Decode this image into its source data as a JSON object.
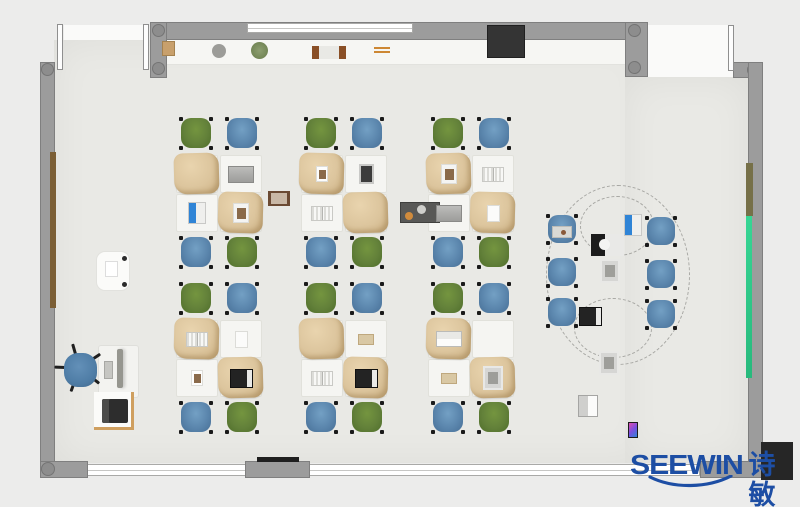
{
  "meta": {
    "description": "Top-down 3D rendered floor plan of a classroom / office furniture layout"
  },
  "logo": {
    "brand": "SEEWIN",
    "brand_cn": "诗敏",
    "color": "#1d4ea4"
  },
  "colors": {
    "outside": "#ececeb",
    "floor": "#e9e9e5",
    "wall": "#9c9c9c",
    "window": "#ffffff",
    "chair_green": "#63813a",
    "chair_blue": "#5b86ad",
    "desk_white": "#f5f5f2",
    "desk_cover_tan": "#dcc59d",
    "board_green": "#2fcd8c",
    "board_brown": "#7b5e35",
    "board_olive": "#767048",
    "cabinet_black": "#343434"
  },
  "shelf_items": [
    {
      "type": "basket",
      "x": 162,
      "y": 41
    },
    {
      "type": "wreath",
      "x": 180,
      "y": 40
    },
    {
      "type": "plate",
      "x": 212,
      "y": 44
    },
    {
      "type": "plant",
      "x": 251,
      "y": 42
    },
    {
      "type": "frame",
      "x": 268,
      "y": 44
    },
    {
      "type": "books",
      "x": 312,
      "y": 46
    },
    {
      "type": "sticks",
      "x": 374,
      "y": 47
    },
    {
      "type": "machine",
      "x": 400,
      "y": 40
    },
    {
      "type": "box",
      "x": 552,
      "y": 43
    },
    {
      "type": "device-bw",
      "x": 591,
      "y": 39
    }
  ],
  "furniture": {
    "cluster_chair_colors": [
      "green",
      "blue",
      "blue",
      "green"
    ],
    "clusters": [
      {
        "x": 176,
        "y": 116,
        "desks": [
          {
            "cover": true,
            "item": ""
          },
          {
            "cover": false,
            "item": "laptop-gray"
          },
          {
            "cover": false,
            "item": "laptop-blue"
          },
          {
            "cover": true,
            "item": "book-photo"
          }
        ]
      },
      {
        "x": 301,
        "y": 116,
        "desks": [
          {
            "cover": true,
            "item": "photo"
          },
          {
            "cover": false,
            "item": "tablet-gray"
          },
          {
            "cover": false,
            "item": "book-open"
          },
          {
            "cover": true,
            "item": ""
          }
        ]
      },
      {
        "x": 428,
        "y": 116,
        "desks": [
          {
            "cover": true,
            "item": "book-photo"
          },
          {
            "cover": false,
            "item": "book-open"
          },
          {
            "cover": false,
            "item": "laptop-gray"
          },
          {
            "cover": true,
            "item": "paper"
          }
        ]
      },
      {
        "x": 176,
        "y": 281,
        "desks": [
          {
            "cover": true,
            "item": "book-open"
          },
          {
            "cover": false,
            "item": "paper"
          },
          {
            "cover": false,
            "item": "photo"
          },
          {
            "cover": true,
            "item": "laptop-dark"
          }
        ]
      },
      {
        "x": 301,
        "y": 281,
        "desks": [
          {
            "cover": true,
            "item": ""
          },
          {
            "cover": false,
            "item": "book-tan"
          },
          {
            "cover": false,
            "item": "book-open"
          },
          {
            "cover": true,
            "item": "laptop-dark"
          }
        ]
      },
      {
        "x": 428,
        "y": 281,
        "desks": [
          {
            "cover": true,
            "item": "laptop-white"
          },
          {
            "cover": false,
            "item": ""
          },
          {
            "cover": false,
            "item": "book-tan"
          },
          {
            "cover": true,
            "item": "tablet-sketch"
          }
        ]
      }
    ],
    "meeting": {
      "chair_color": "blue",
      "chairs": [
        [
          545,
          213
        ],
        [
          644,
          215
        ],
        [
          545,
          256
        ],
        [
          644,
          258
        ],
        [
          545,
          296
        ],
        [
          644,
          298
        ]
      ],
      "devices": [
        {
          "type": "laptop-blue",
          "x": 624,
          "y": 214
        },
        {
          "type": "tablet-sketch",
          "x": 600,
          "y": 237
        },
        {
          "type": "laptop-dark",
          "x": 579,
          "y": 261
        },
        {
          "type": "tablet-sketch",
          "x": 599,
          "y": 286
        },
        {
          "type": "laptop-open",
          "x": 578,
          "y": 306
        },
        {
          "type": "phone-color",
          "x": 628,
          "y": 311
        }
      ],
      "dashes": [
        [
          546,
          185,
          144,
          180
        ],
        [
          580,
          196,
          74,
          60
        ],
        [
          574,
          298,
          78,
          60
        ]
      ]
    },
    "teacher": {
      "side_table": [
        96,
        251,
        34,
        40
      ],
      "desk": [
        98,
        345,
        41,
        53
      ],
      "monitor": [
        117,
        349,
        6,
        39
      ],
      "keyboard": [
        104,
        361,
        9,
        18
      ],
      "chair": [
        61,
        350,
        39,
        44
      ],
      "printer_table": [
        94,
        392,
        40,
        38
      ],
      "printer": [
        102,
        399,
        26,
        24
      ]
    }
  }
}
